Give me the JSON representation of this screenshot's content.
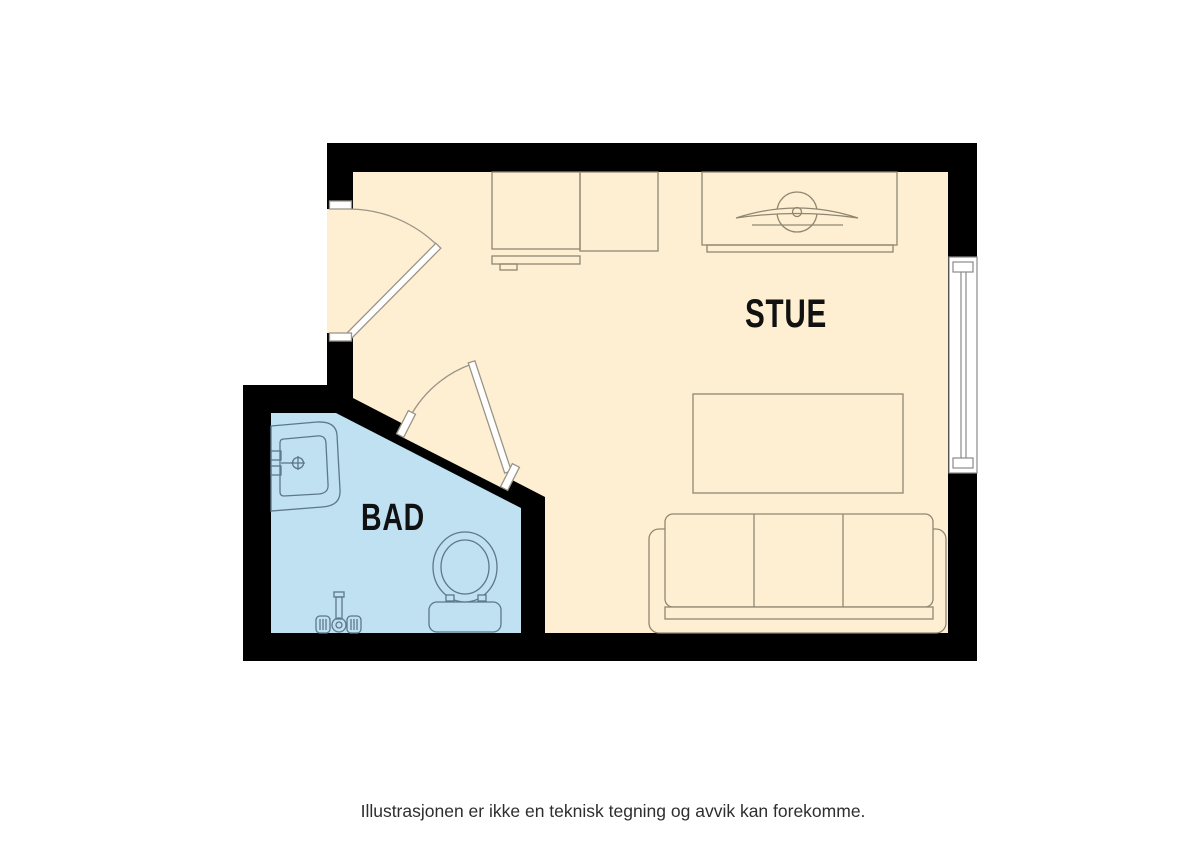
{
  "floorplan": {
    "rooms": {
      "stue": {
        "label": "STUE",
        "floor_color": "#FFEFD2"
      },
      "bad": {
        "label": "BAD",
        "floor_color": "#BFE1F2"
      }
    },
    "colors": {
      "wall": "#000000",
      "background": "#FFFFFF",
      "stue_furniture_line": "#8F8672",
      "bad_fixture_line": "#5D7889",
      "door_line": "#9A9488",
      "door_fill": "#FFFFFF",
      "window_line": "#8A8A8A",
      "window_fill": "#FFFFFF",
      "label_text": "#111111",
      "disclaimer_text": "#2E2E2E"
    },
    "furniture": {
      "stue": [
        "wardrobe",
        "shelf",
        "tv-bench",
        "tv",
        "coffee-table",
        "sofa"
      ],
      "bad": [
        "sink",
        "toilet",
        "shower-mixer"
      ]
    }
  },
  "footer": {
    "disclaimer": "Illustrasjonen er ikke en teknisk tegning og avvik kan forekomme."
  }
}
